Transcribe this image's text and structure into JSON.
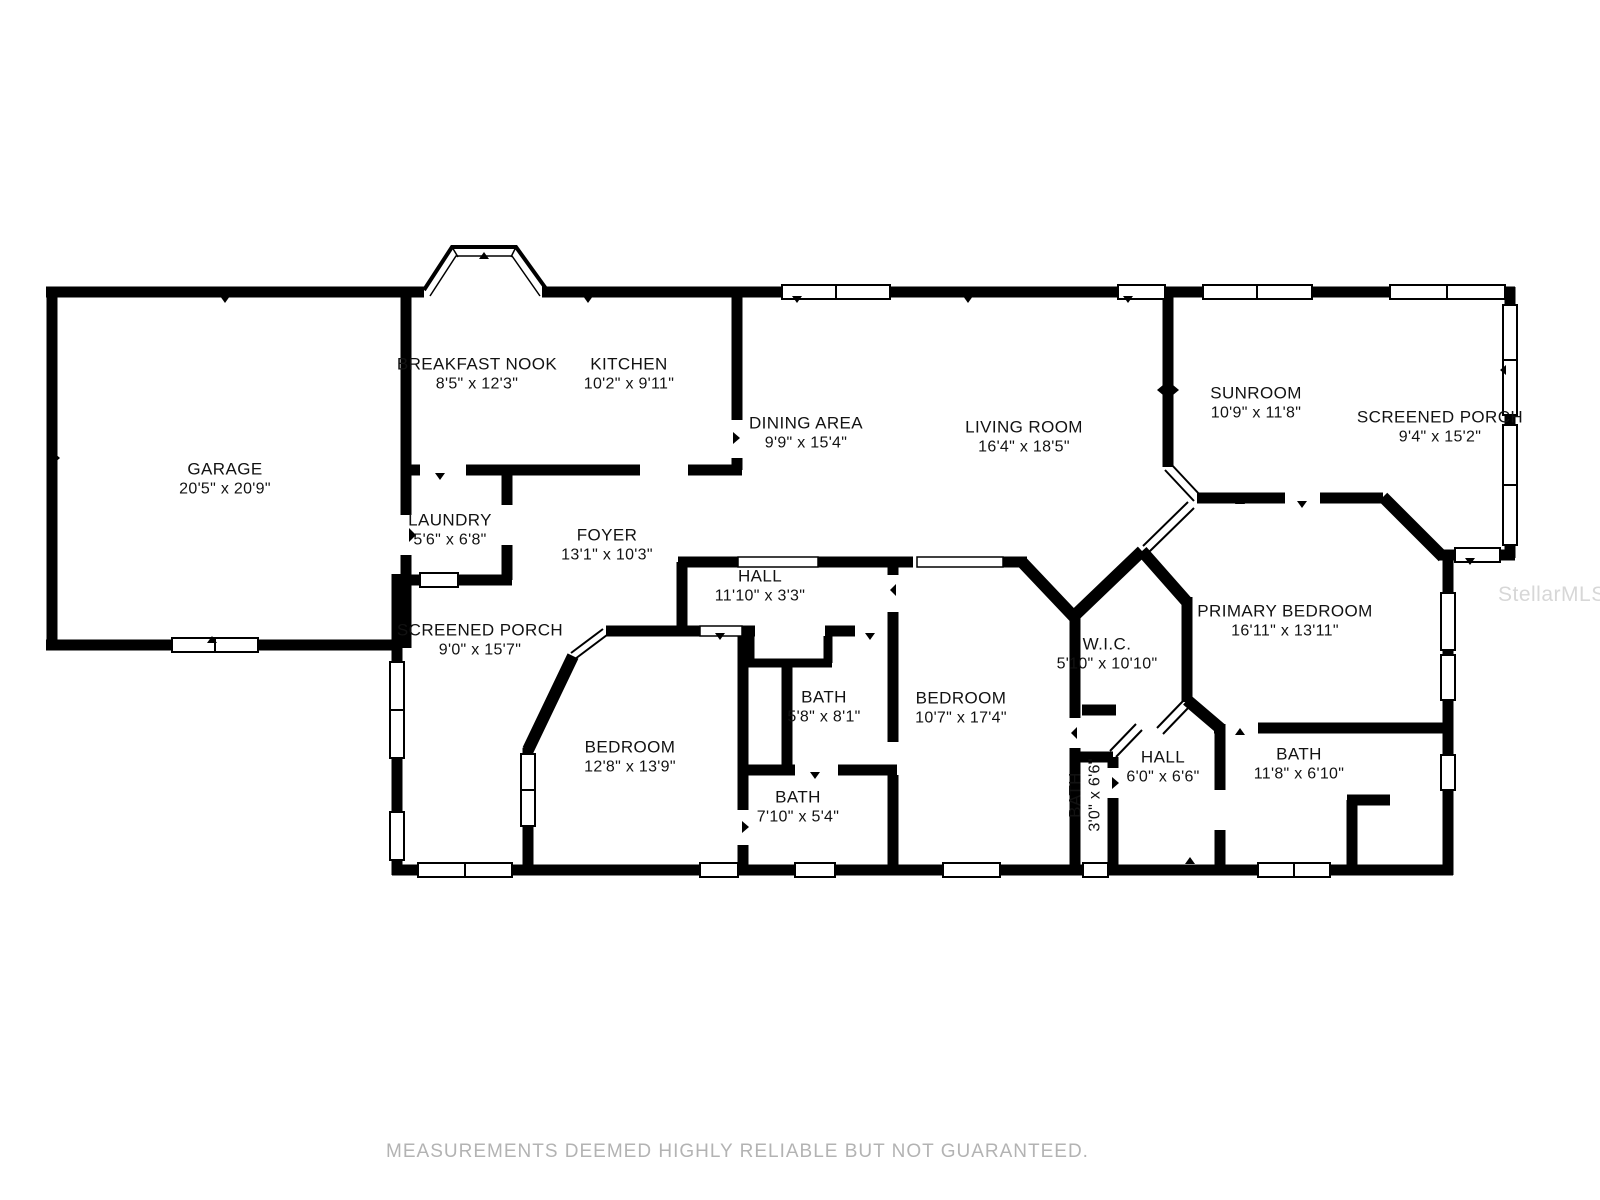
{
  "rooms": [
    {
      "id": "garage",
      "name": "GARAGE",
      "dims": "20'5\" x 20'9\""
    },
    {
      "id": "breakfast-nook",
      "name": "BREAKFAST NOOK",
      "dims": "8'5\" x 12'3\""
    },
    {
      "id": "kitchen",
      "name": "KITCHEN",
      "dims": "10'2\" x 9'11\""
    },
    {
      "id": "dining-area",
      "name": "DINING AREA",
      "dims": "9'9\" x 15'4\""
    },
    {
      "id": "living-room",
      "name": "LIVING ROOM",
      "dims": "16'4\" x 18'5\""
    },
    {
      "id": "sunroom",
      "name": "SUNROOM",
      "dims": "10'9\" x 11'8\""
    },
    {
      "id": "screened-porch-right",
      "name": "SCREENED PORCH",
      "dims": "9'4\" x 15'2\""
    },
    {
      "id": "laundry",
      "name": "LAUNDRY",
      "dims": "5'6\" x 6'8\""
    },
    {
      "id": "foyer",
      "name": "FOYER",
      "dims": "13'1\" x 10'3\""
    },
    {
      "id": "hall-upper",
      "name": "HALL",
      "dims": "11'10\" x 3'3\""
    },
    {
      "id": "screened-porch-left",
      "name": "SCREENED PORCH",
      "dims": "9'0\" x 15'7\""
    },
    {
      "id": "wic",
      "name": "W.I.C.",
      "dims": "5'10\" x 10'10\""
    },
    {
      "id": "primary-bedroom",
      "name": "PRIMARY BEDROOM",
      "dims": "16'11\" x 13'11\""
    },
    {
      "id": "bath-58",
      "name": "BATH",
      "dims": "5'8\" x 8'1\""
    },
    {
      "id": "bedroom-107",
      "name": "BEDROOM",
      "dims": "10'7\" x 17'4\""
    },
    {
      "id": "bedroom-128",
      "name": "BEDROOM",
      "dims": "12'8\" x 13'9\""
    },
    {
      "id": "bath-710",
      "name": "BATH",
      "dims": "7'10\" x 5'4\""
    },
    {
      "id": "bath-30",
      "name": "BATH",
      "dims": "3'0\" x 6'6\""
    },
    {
      "id": "hall-lower",
      "name": "HALL",
      "dims": "6'0\" x 6'6\""
    },
    {
      "id": "bath-118",
      "name": "BATH",
      "dims": "11'8\" x 6'10\""
    }
  ],
  "footer": {
    "disclaimer": "MEASUREMENTS DEEMED HIGHLY RELIABLE BUT NOT GUARANTEED."
  },
  "watermark": "StellarMLS",
  "colors": {
    "wall": "#000000",
    "label_text": "#121212",
    "disclaimer_text": "#b3b3b3",
    "watermark_text": "#d7d7d7",
    "background": "#ffffff"
  }
}
